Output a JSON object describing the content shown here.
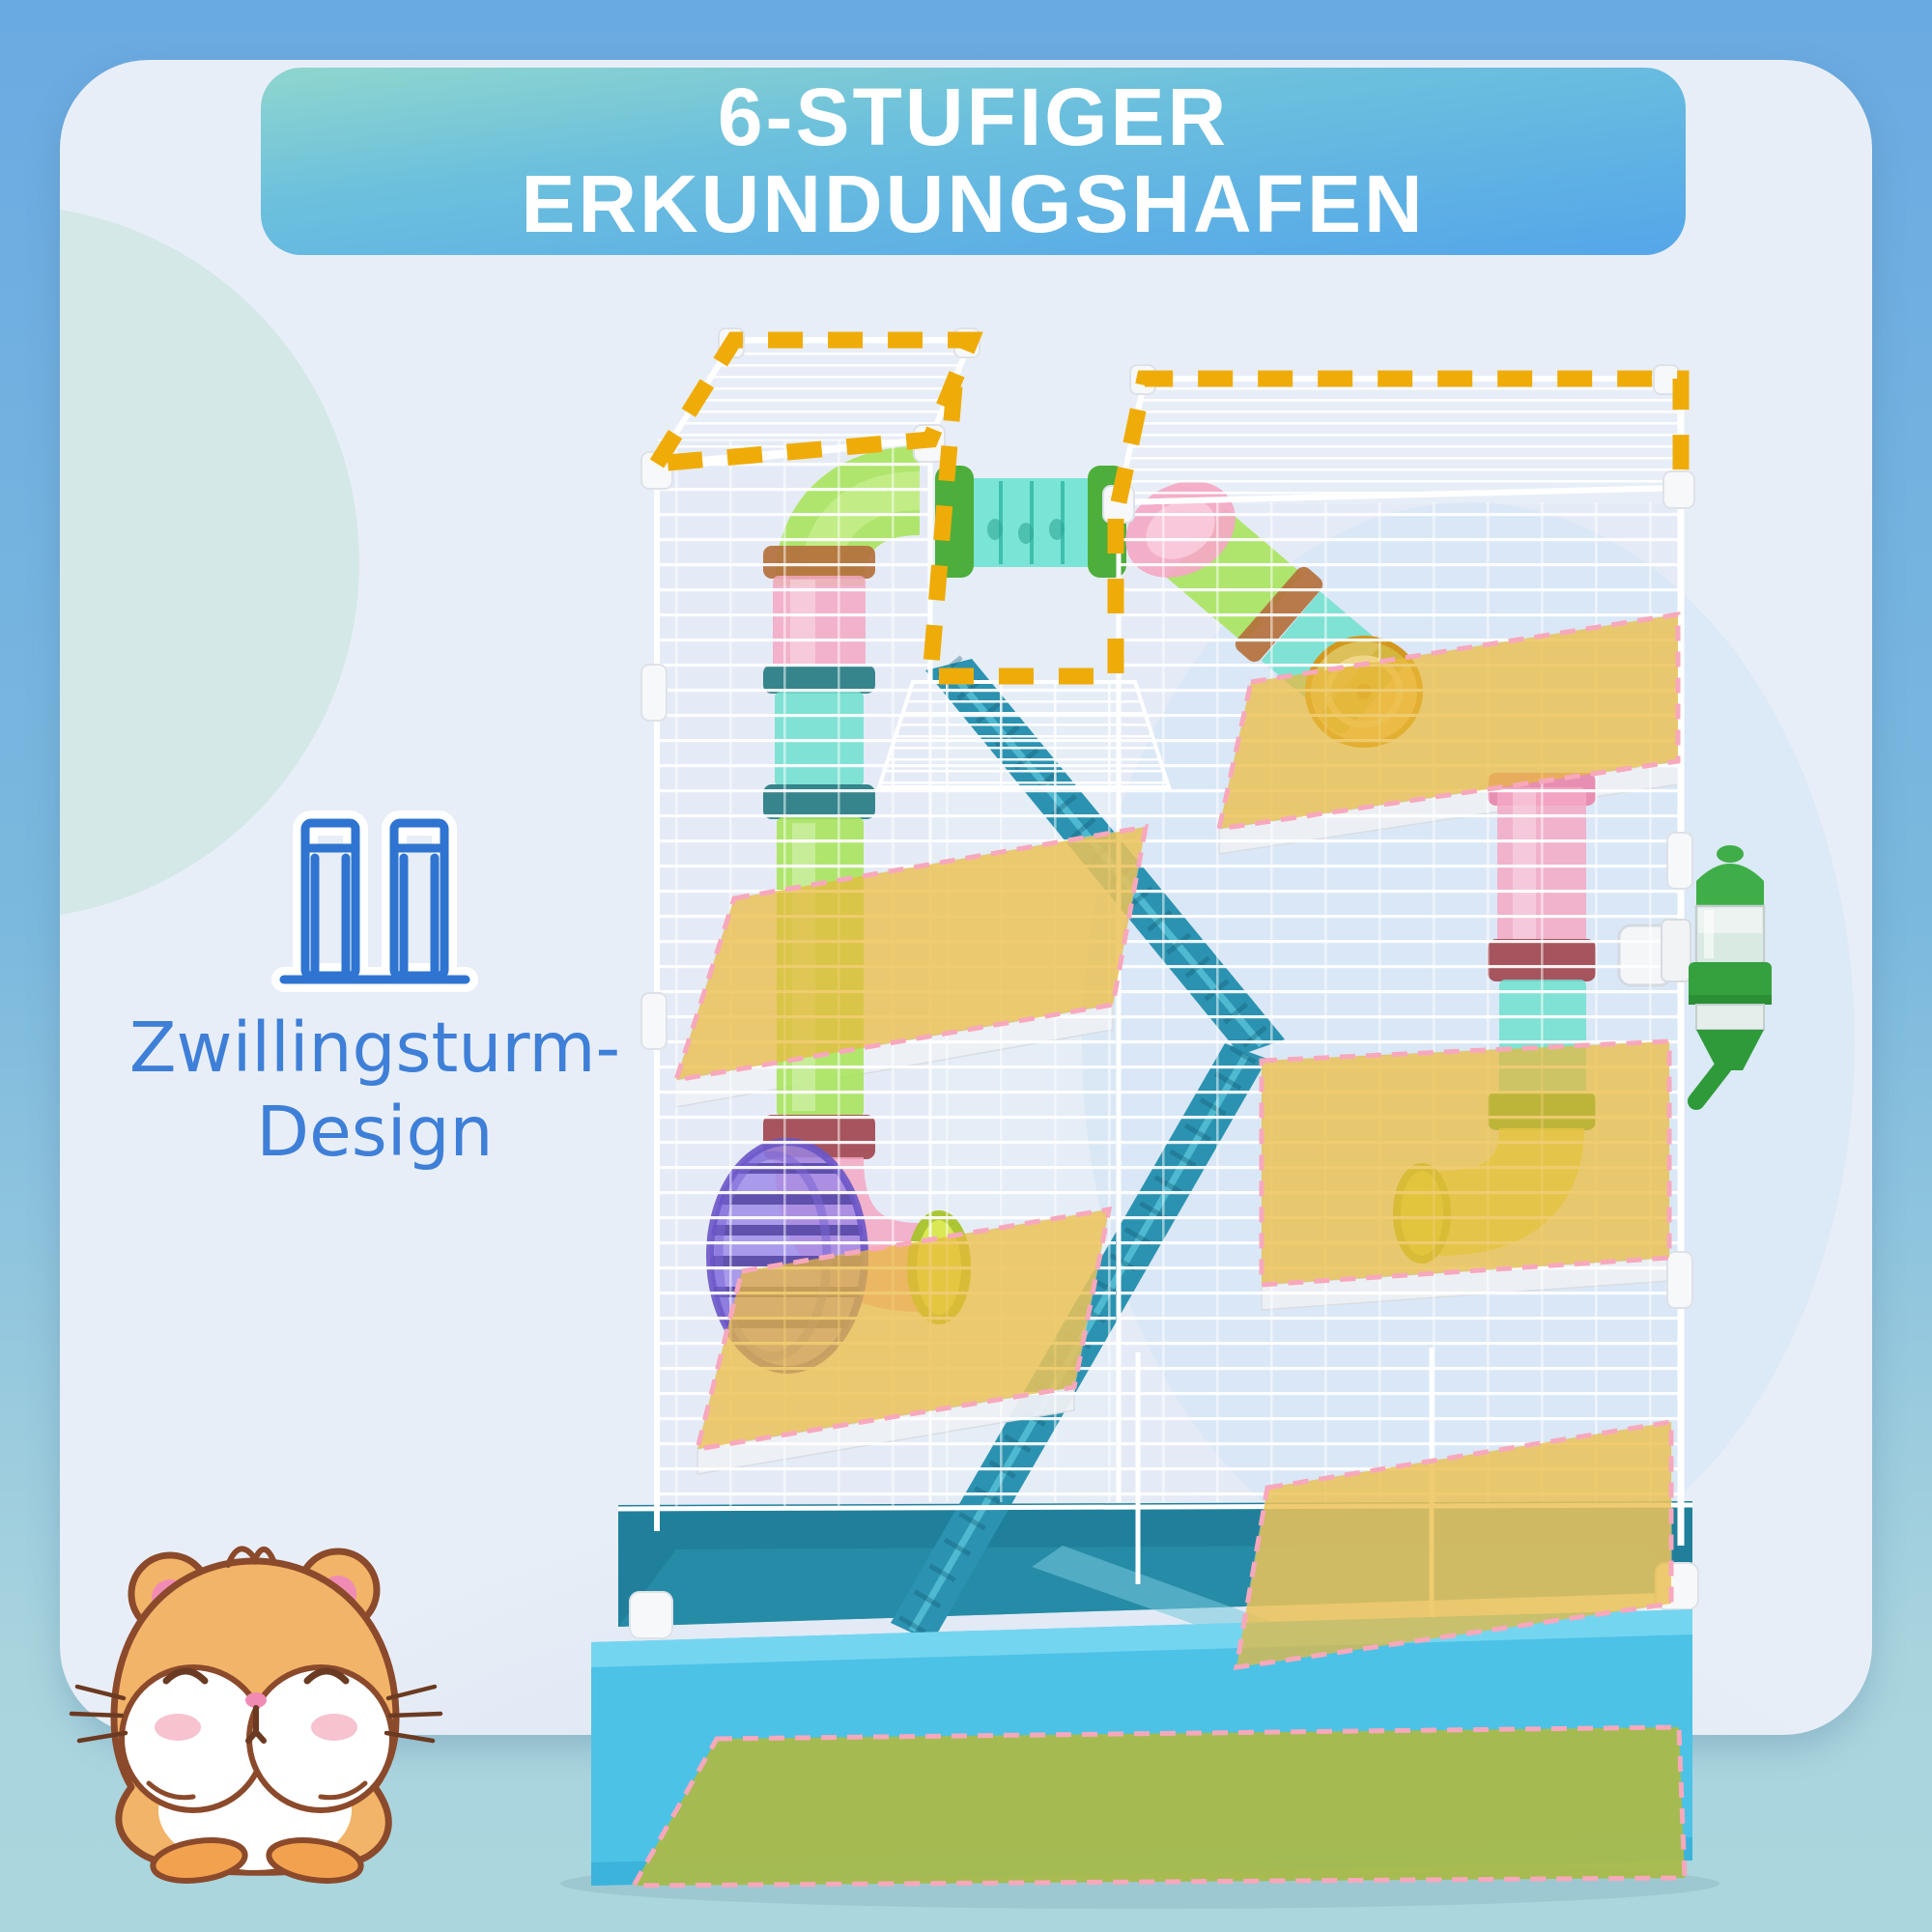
{
  "header": {
    "title_line1": "6-STUFIGER",
    "title_line2": "ERKUNDUNGSHAFEN"
  },
  "feature": {
    "icon": "twin-towers-icon",
    "label_line1": "Zwillingsturm-",
    "label_line2": "Design"
  },
  "product_visual": {
    "type": "hamster-cage-product-photo",
    "highlight_overlays": [
      "top-deck-highlight-left",
      "top-deck-highlight-right",
      "top-balcony-highlight",
      "platform-level-overlay-1",
      "platform-level-overlay-2",
      "platform-level-overlay-3",
      "platform-level-overlay-4",
      "platform-level-overlay-5",
      "floor-mat-overlay"
    ],
    "accessories": [
      "connector-tube",
      "curved-play-tubes",
      "exercise-wheel-purple",
      "exercise-wheel-orange",
      "ladder-ramps",
      "water-bottle",
      "food-dish",
      "deep-base-tray"
    ]
  },
  "mascot": {
    "type": "hamster-mascot-illustration"
  },
  "colors": {
    "background_top": "#6AAAE2",
    "background_bottom": "#A9D4DE",
    "panel": "#E8EEF7",
    "banner_gradient_top": "#8FD6CE",
    "banner_gradient_bottom": "#54A6E9",
    "title_text": "#FFFFFF",
    "feature_text": "#3E7FD8",
    "feature_icon": "#2F74D0",
    "highlight_dash": "#EFAC08",
    "platform_overlay": "#E9B93A",
    "overlay_dash_pink": "#F7A8BC",
    "floor_mat": "#A9BA4C",
    "base_tray": "#4CC2E6",
    "base_interior": "#20809B",
    "ladder_teal": "#2B93B1",
    "tube_pink": "#F4A8C4",
    "tube_green": "#A6E455",
    "tube_teal": "#6FE0CE",
    "wheel_purple": "#9A86E8",
    "bottle_green": "#3FAE48",
    "hamster_fur": "#F2B468"
  }
}
